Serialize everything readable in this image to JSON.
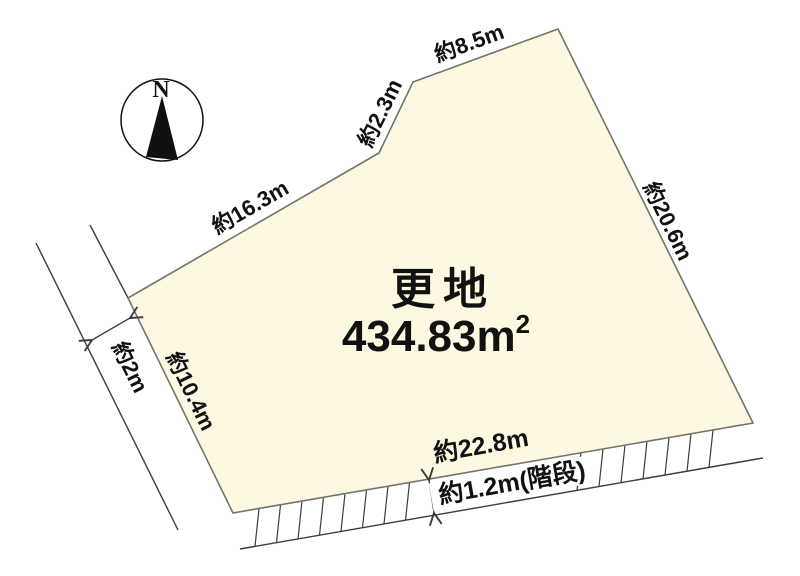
{
  "diagram": {
    "compass_label": "N",
    "parcel": {
      "land_type": "更地",
      "area_value": "434.83",
      "area_unit": "m",
      "area_exponent": "2"
    },
    "dimensions": {
      "edge_top_left": "約16.3m",
      "edge_bevel": "約2.3m",
      "edge_top_right": "約8.5m",
      "edge_right": "約20.6m",
      "edge_left": "約10.4m",
      "edge_bottom": "約22.8m",
      "stairs_width": "約1.2m(階段)",
      "road_width": "約2m"
    }
  },
  "colors": {
    "background": "#ffffff",
    "parcel_fill": "#fcf8e2",
    "parcel_stroke": "#74746a",
    "line": "#3c3c3c",
    "text": "#111111"
  }
}
